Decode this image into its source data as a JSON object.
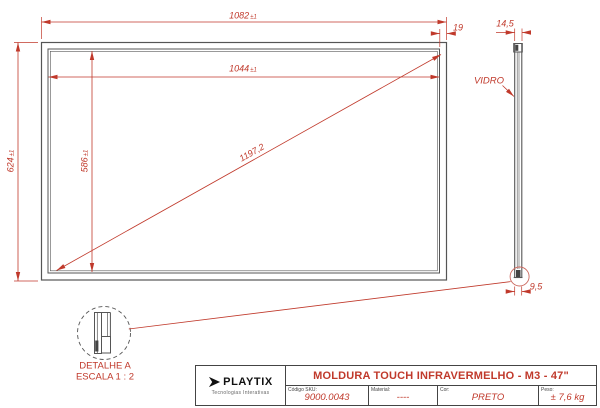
{
  "colors": {
    "dimension_red": "#c0392b",
    "line_gray": "#555555",
    "detail_circle_red": "#cc6a60"
  },
  "front_view": {
    "dim_width_outer": {
      "value": "1082",
      "tol": "±1"
    },
    "dim_width_inner": {
      "value": "1044",
      "tol": "±1"
    },
    "dim_height_outer": {
      "value": "624",
      "tol": "±1"
    },
    "dim_height_inner": {
      "value": "586",
      "tol": "±1"
    },
    "dim_diagonal": "1197,2",
    "dim_border_width": "19"
  },
  "side_view": {
    "dim_thickness": "14,5",
    "dim_bottom_profile": "9,5",
    "glass_label": "VIDRO"
  },
  "detail_view": {
    "title": "DETALHE A",
    "scale": "ESCALA 1 : 2"
  },
  "title_block": {
    "logo_text": "PLAYTIX",
    "logo_subtitle": "Tecnologias Interativas",
    "title": "MOLDURA TOUCH INFRAVERMELHO - M3 - 47\"",
    "fields": [
      {
        "label": "Código SKU:",
        "value": "9000.0043"
      },
      {
        "label": "Material:",
        "value": "----"
      },
      {
        "label": "Cor:",
        "value": "PRETO"
      },
      {
        "label": "Peso:",
        "value": "± 7,6 kg"
      }
    ]
  }
}
